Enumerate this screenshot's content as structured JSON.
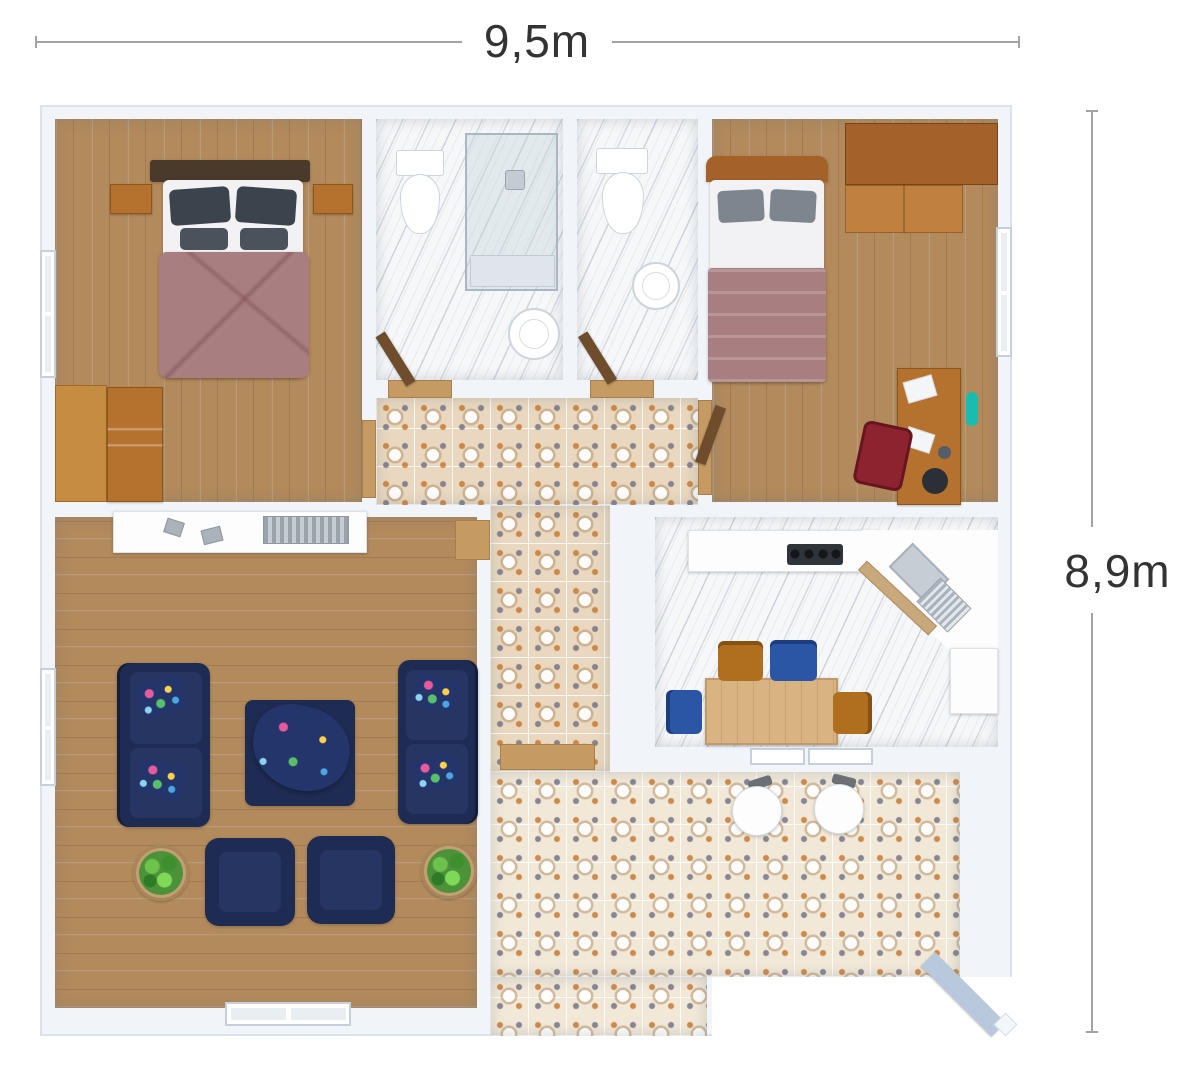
{
  "dimension_labels": {
    "width": "9,5m",
    "height": "8,9m"
  },
  "palette": {
    "wall": "#f1f5f9",
    "wood_floor": "#b28a5c",
    "marble_floor": "#f6f7f9",
    "tile_floor": "#e9d8bf",
    "navy_sofa": "#1e2b52",
    "mauve_bedding": "#a87e80",
    "dark_pillow": "#3b434c",
    "wood_furniture": "#b5722f",
    "accent_teal": "#19bdb0",
    "chair_orange": "#b06f1e",
    "chair_blue": "#2b55a5",
    "chair_red": "#8e2330",
    "plant_green": "#4c923b",
    "dimension_text": "#333333"
  },
  "legend": {
    "rooms": [
      {
        "id": "bedroom-1",
        "furniture": [
          "double-bed",
          "nightstand",
          "nightstand",
          "dresser",
          "window"
        ]
      },
      {
        "id": "bathroom-1",
        "furniture": [
          "toilet",
          "shower",
          "sink"
        ]
      },
      {
        "id": "bathroom-2",
        "furniture": [
          "toilet",
          "sink"
        ]
      },
      {
        "id": "bedroom-2",
        "furniture": [
          "single-bed",
          "wardrobe",
          "desk",
          "desk-chair",
          "window"
        ]
      },
      {
        "id": "hallway",
        "furniture": [
          "patterned-tiles"
        ]
      },
      {
        "id": "living-room",
        "furniture": [
          "sideboard",
          "sofa",
          "sofa",
          "ottoman-coffee-table",
          "armchair",
          "armchair",
          "plant",
          "plant",
          "window",
          "window"
        ]
      },
      {
        "id": "kitchen-dining",
        "furniture": [
          "counter",
          "cooktop",
          "corner-sink",
          "dining-table",
          "chair-orange",
          "chair-blue",
          "chair-blue",
          "chair-orange",
          "window",
          "window"
        ]
      },
      {
        "id": "terrace",
        "furniture": [
          "stool",
          "stool",
          "patterned-tiles"
        ]
      }
    ]
  }
}
